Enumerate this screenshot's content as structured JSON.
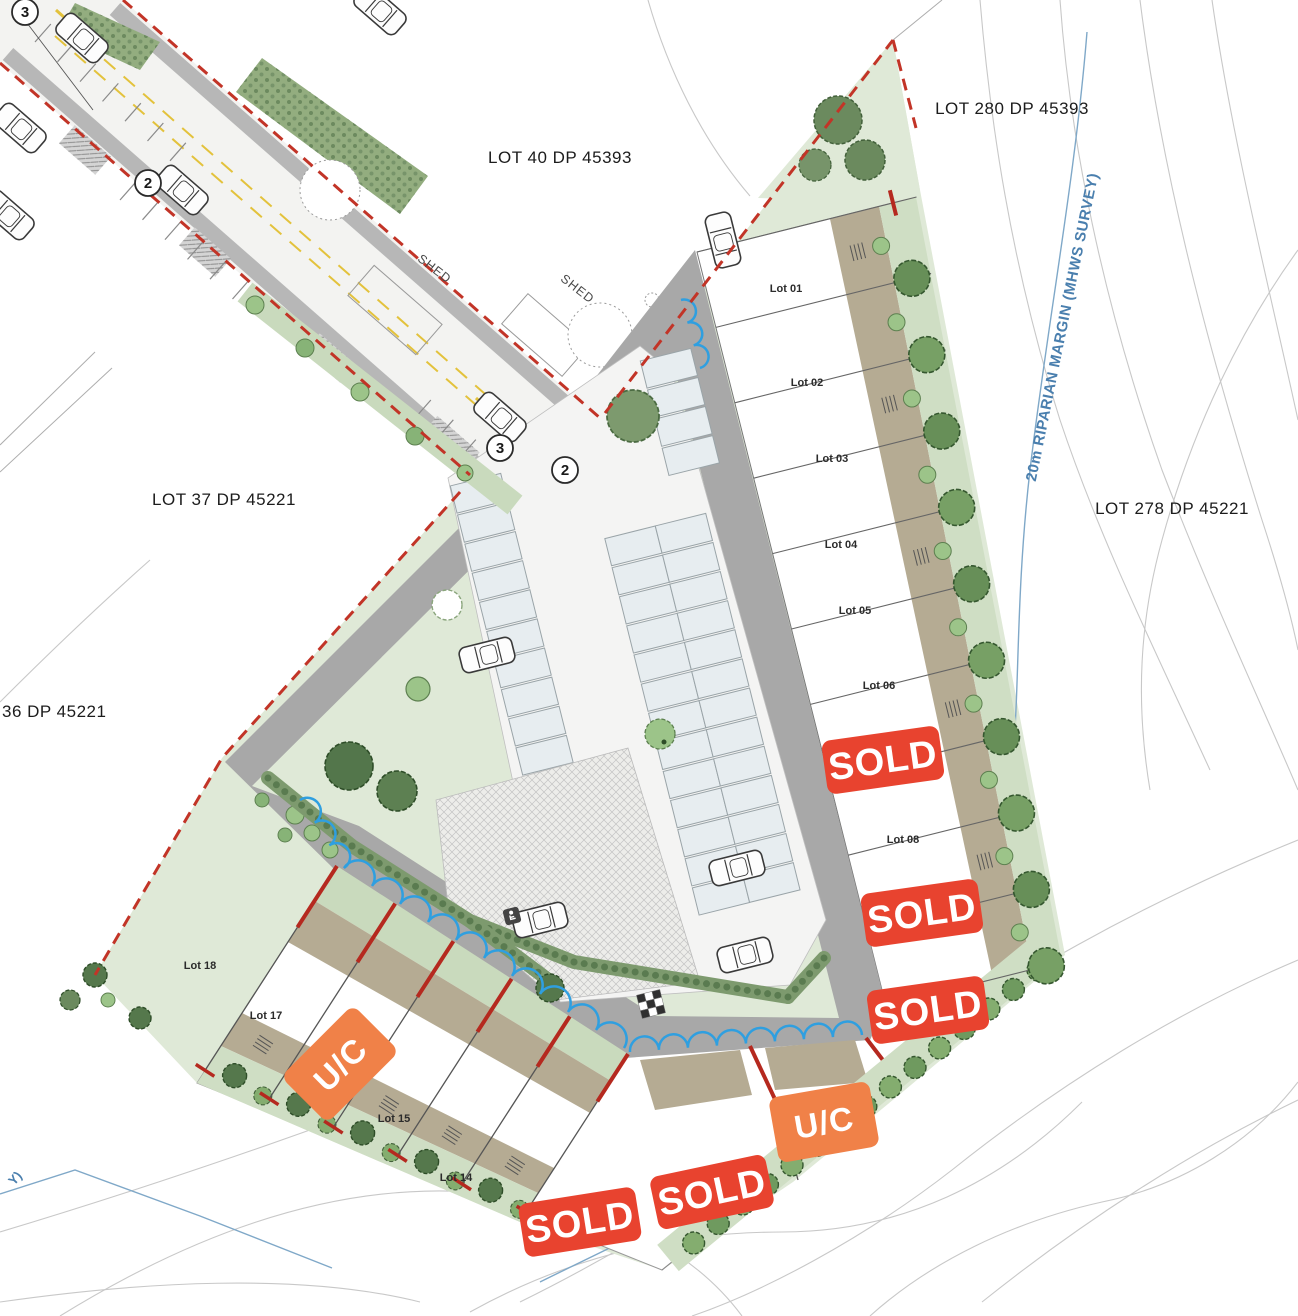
{
  "plan": {
    "parcel_labels": [
      {
        "text": "LOT 40 DP 45393",
        "x": 560,
        "y": 163
      },
      {
        "text": "LOT 280 DP 45393",
        "x": 1012,
        "y": 114
      },
      {
        "text": "LOT 278 DP 45221",
        "x": 1172,
        "y": 514
      },
      {
        "text": "LOT 37 DP 45221",
        "x": 224,
        "y": 505
      },
      {
        "text": "36 DP 45221",
        "x": 2,
        "y": 717
      }
    ],
    "lot_labels": [
      {
        "text": "Lot 01",
        "x": 786,
        "y": 292
      },
      {
        "text": "Lot 02",
        "x": 807,
        "y": 386
      },
      {
        "text": "Lot 03",
        "x": 832,
        "y": 462
      },
      {
        "text": "Lot 04",
        "x": 841,
        "y": 548
      },
      {
        "text": "Lot 05",
        "x": 855,
        "y": 614
      },
      {
        "text": "Lot 06",
        "x": 879,
        "y": 689
      },
      {
        "text": "Lot 08",
        "x": 903,
        "y": 843
      },
      {
        "text": "Lot 14",
        "x": 456,
        "y": 1181
      },
      {
        "text": "Lot 15",
        "x": 394,
        "y": 1122
      },
      {
        "text": "Lot 17",
        "x": 266,
        "y": 1019
      },
      {
        "text": "Lot 18",
        "x": 200,
        "y": 969
      }
    ],
    "badges": [
      {
        "label": "SOLD",
        "type": "sold"
      },
      {
        "label": "SOLD",
        "type": "sold"
      },
      {
        "label": "SOLD",
        "type": "sold"
      },
      {
        "label": "U/C",
        "type": "uc"
      },
      {
        "label": "SOLD",
        "type": "sold"
      },
      {
        "label": "SOLD",
        "type": "sold"
      },
      {
        "label": "U/C",
        "type": "uc"
      }
    ],
    "road_markers": [
      {
        "text": "3",
        "x": 25,
        "y": 12
      },
      {
        "text": "2",
        "x": 148,
        "y": 183
      },
      {
        "text": "3",
        "x": 500,
        "y": 448
      },
      {
        "text": "2",
        "x": 565,
        "y": 470
      }
    ],
    "shed_labels": [
      {
        "text": "SHED"
      },
      {
        "text": "SHED"
      }
    ],
    "riparian_label": {
      "text": "20m RIPARIAN MARGIN (MHWS SURVEY)"
    },
    "corner_label": {
      "text": "Y)"
    },
    "colors": {
      "sold_badge": "#e8432f",
      "uc_badge": "#f08148",
      "boundary_red": "#c23427",
      "marker_magenta": "#d628a",
      "water_blue": "#2f9fe0",
      "riparian_blue": "#4a7fae",
      "road_gray": "#a8a8a8",
      "site_green": "#dfe9d7",
      "planting_green": "#7d9a6e",
      "pad_tan": "#b5ab93"
    }
  }
}
